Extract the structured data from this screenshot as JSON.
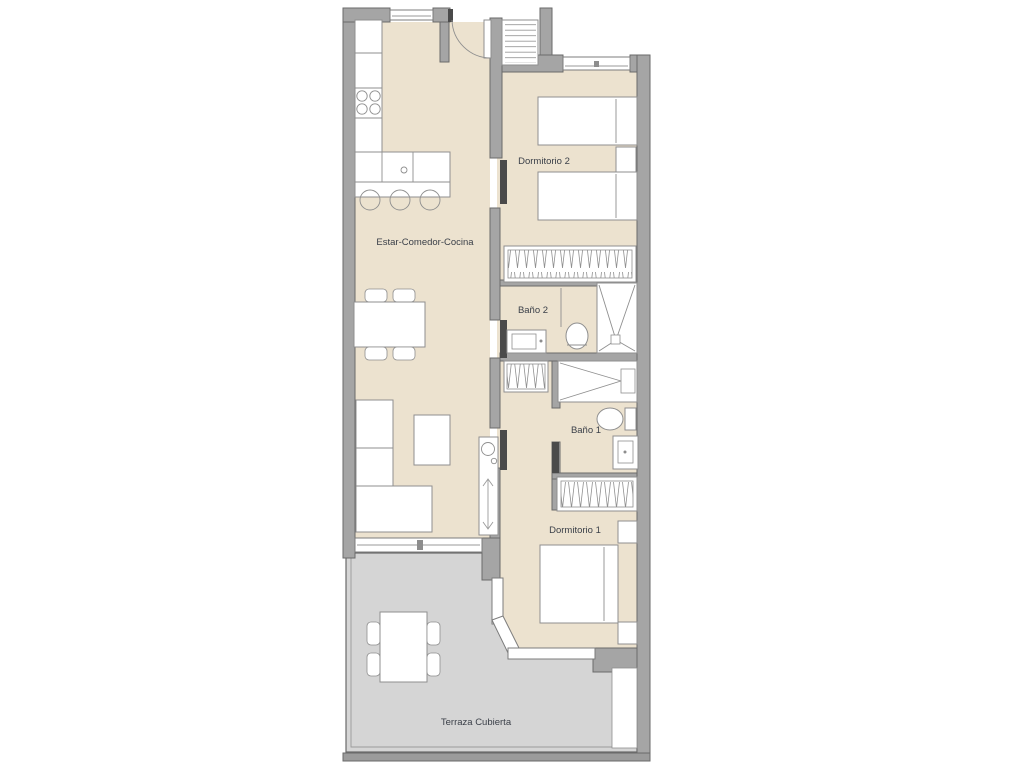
{
  "colors": {
    "background": "#ffffff",
    "wall": "#a5a5a5",
    "wall_stroke": "#6a6a6a",
    "floor_interior": "#ece2cf",
    "floor_terrace": "#d5d5d5",
    "furniture_fill": "#ffffff",
    "furniture_stroke": "#8f8f8f",
    "door_leaf": "#4a4a4a",
    "glass": "#ffffff",
    "label": "#3a3f48"
  },
  "plan": {
    "type": "apartment-floor-plan",
    "rooms": [
      {
        "id": "living",
        "label": "Estar-Comedor-Cocina"
      },
      {
        "id": "bedroom2",
        "label": "Dormitorio 2"
      },
      {
        "id": "bath2",
        "label": "Baño 2"
      },
      {
        "id": "bath1",
        "label": "Baño 1"
      },
      {
        "id": "bedroom1",
        "label": "Dormitorio 1"
      },
      {
        "id": "terrace",
        "label": "Terraza Cubierta"
      }
    ]
  }
}
